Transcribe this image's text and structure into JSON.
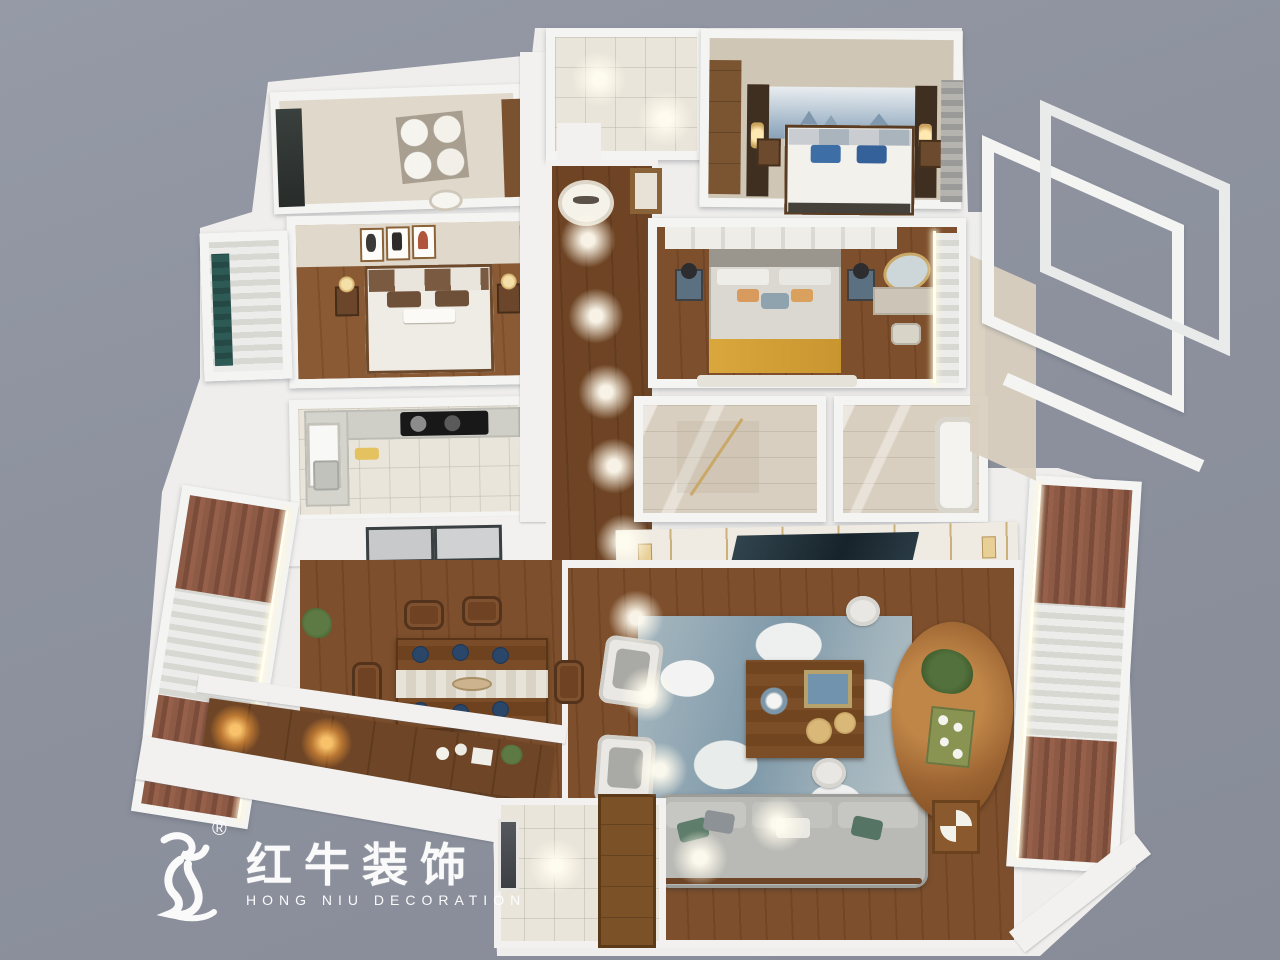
{
  "meta": {
    "canvas": {
      "width": 1280,
      "height": 960
    },
    "scene_type": "apartment-3d-floorplan-render",
    "background_color": "#8d929e"
  },
  "watermark": {
    "icon": "hongniu-bull-logo",
    "registered_mark": "®",
    "brand_cn": "红牛装饰",
    "brand_en": "HONG NIU DECORATION",
    "color": "#ffffff"
  },
  "scene": {
    "palette": {
      "wall_white": "#f2f1ef",
      "wood_floor": "#7d4f2c",
      "tile_floor": "#eae5da",
      "bath_marble": "#d9cfc0",
      "rug_blue": "#89a0ae",
      "sofa_gray": "#b9bab6",
      "pillow_blue": "#3e6ea6",
      "throw_yellow": "#d9a73c",
      "curtain_rust": "#8c5a45",
      "curtain_teal": "#2e5a55",
      "plate_navy": "#1d3350",
      "trim_gold": "#c9a868",
      "cooktop_black": "#181818",
      "mural_blue": "#9fb4c7"
    },
    "rooms": [
      {
        "id": "display-room",
        "label": "room with 2x2 decorative plate wall art"
      },
      {
        "id": "bedroom-2",
        "label": "bedroom with triple artwork, wood wardrobe, teal-curtain bay window"
      },
      {
        "id": "kitchen",
        "label": "L-shaped kitchen with black cooktop and window"
      },
      {
        "id": "hallway",
        "label": "wood corridor with spotlights and round mirror"
      },
      {
        "id": "shower-room",
        "label": "top shower room with downlights"
      },
      {
        "id": "master-bedroom",
        "label": "bedroom with mountain mural and blue bedding"
      },
      {
        "id": "bedroom-3",
        "label": "bedroom with yellow throw, blue nightstands and round-mirror vanity"
      },
      {
        "id": "bathroom-a",
        "label": "bathroom with gold-framed glass shower"
      },
      {
        "id": "bathroom-b",
        "label": "bathroom with bathtub"
      },
      {
        "id": "balcony-frame",
        "label": "open white-frame glazed balcony"
      },
      {
        "id": "living-room",
        "label": "living room: gray sofa, blue abstract rug, live-edge tea table, TV wall"
      },
      {
        "id": "dining-room",
        "label": "dining room: six-seat wood table with navy place settings"
      },
      {
        "id": "entry",
        "label": "entry with security door and tall wood cabinet"
      },
      {
        "id": "window-wall-left",
        "label": "window wall with rust drapes and sheers"
      },
      {
        "id": "window-wall-right",
        "label": "window wall with rust drapes and sheers"
      }
    ]
  }
}
